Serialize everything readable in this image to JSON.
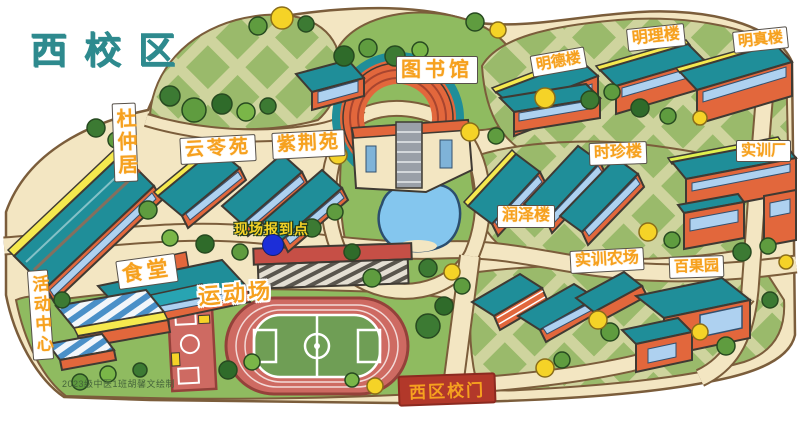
{
  "title": "西校区",
  "labels": {
    "duzhongju": "杜仲居",
    "yunlingyuan": "云苓苑",
    "zijingyuan": "紫荆苑",
    "library": "图书馆",
    "mingde": "明德楼",
    "mingli": "明理楼",
    "mingzhen": "明真楼",
    "shizhen": "时珍楼",
    "shixun_factory": "实训厂",
    "runze": "润泽楼",
    "shixun_farm": "实训农场",
    "baiguoyuan": "百果园",
    "canteen": "食堂",
    "sports": "运动场",
    "activity": "活动中心",
    "checkin": "现场报到点",
    "gate": "西区校门",
    "credit": "2023级中医1班胡馨文绘制"
  },
  "colors": {
    "title_text": "#2e8a8e",
    "label_text": "#f6a11f",
    "building_roof": "#1f8e99",
    "building_wall": "#e2673c",
    "pond": "#84c6ee",
    "checkin_dot": "#1c2ed8",
    "gate_banner": "#b2382a",
    "track": "#ce6a62",
    "lawn": "#8fbb60"
  }
}
